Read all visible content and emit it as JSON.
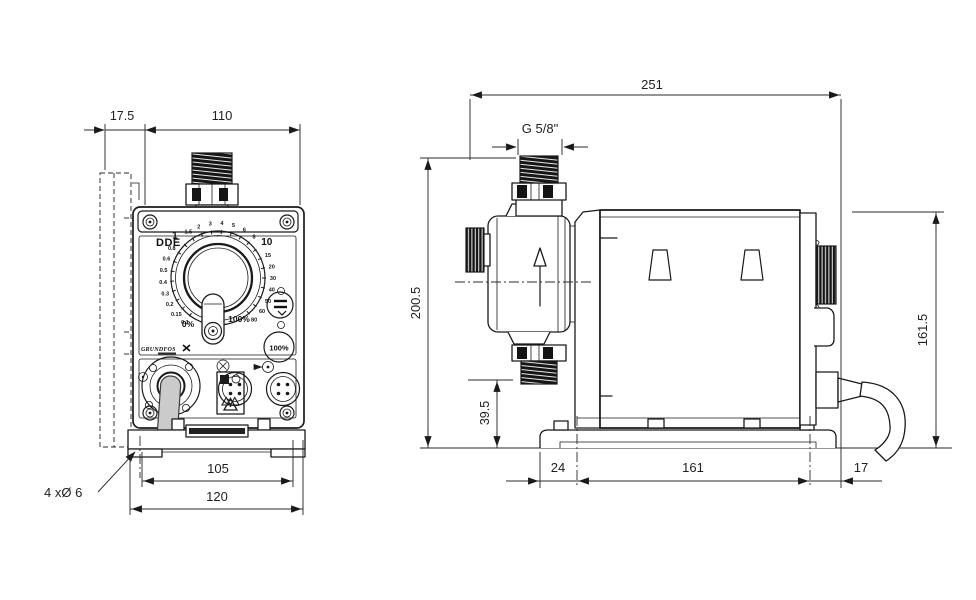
{
  "drawing_type": "pump dimensional drawing",
  "front_view": {
    "model_label": "DDE",
    "brand_logo": "GRUNDFOS",
    "dial": {
      "labels": [
        "0.1",
        "0.15",
        "0.2",
        "0.3",
        "0.4",
        "0.5",
        "0.6",
        "0.8",
        "1",
        "1.5",
        "2",
        "3",
        "4",
        "5",
        "6",
        "8",
        "10",
        "15",
        "20",
        "30",
        "40",
        "50",
        "60",
        "80"
      ],
      "big_labels": [
        "1",
        "10"
      ],
      "min_label": "0%",
      "max_label": "100%"
    },
    "prime_button_label": "100%",
    "dims": {
      "bracket_depth": "17.5",
      "width": "110",
      "hole_span": "105",
      "base_width": "120",
      "mounting_holes": "4 xØ 6"
    }
  },
  "side_view": {
    "dims": {
      "overall_length": "251",
      "thread": "G 5/8\"",
      "overall_height": "200.5",
      "valve_height": "39.5",
      "housing_height": "161.5",
      "base_front_offset": "24",
      "hole_spacing": "161",
      "base_rear_offset": "17"
    }
  },
  "icons": {
    "flow_direction": "up-arrow",
    "warning": "warning-triangle",
    "vent_valve": "knurled-knob",
    "signal_connectors": "4-pin-round",
    "prime_key": "100%-circle"
  },
  "colors": {
    "line": "#1a1a1a",
    "dim_text": "#1f1f1f",
    "tube_fill": "#cbcbcb",
    "dark_fill": "#141414"
  }
}
